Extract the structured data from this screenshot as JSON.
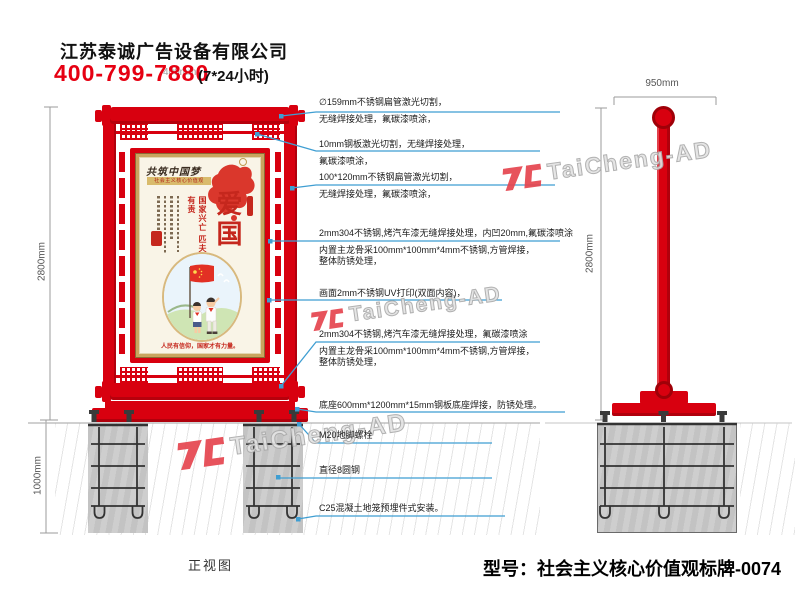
{
  "header": {
    "company": "江苏泰诚广告设备有限公司",
    "phone": "400-799-7880",
    "hours": "(7*24小时)",
    "overlay_dim": "400mm"
  },
  "watermark_text": "TaiCheng-AD",
  "front_view": {
    "label": "正视图",
    "dim_height": "2800mm",
    "dim_underground": "1000mm",
    "poster": {
      "calligraphy": "共筑中国梦",
      "band": "社会主义核心价值观",
      "headline": "爱国",
      "slogan_col1": "国家兴亡",
      "slogan_col2": "匹夫有责",
      "footer": "人民有信仰，国家才有力量。"
    }
  },
  "side_view": {
    "dim_width": "950mm",
    "dim_height": "2800mm"
  },
  "annotations": [
    {
      "lines": [
        "∅159mm不锈钢扁管激光切割，",
        "无缝焊接处理，氟碳漆喷涂，"
      ]
    },
    {
      "lines": [
        "10mm钢板激光切割，无缝焊接处理，",
        "氟碳漆喷涂，"
      ]
    },
    {
      "lines": [
        "100*120mm不锈钢扁管激光切割，",
        "无缝焊接处理，氟碳漆喷涂，"
      ]
    },
    {
      "lines": [
        "2mm304不锈钢,烤汽车漆无缝焊接处理，内凹20mm,氟碳漆喷涂",
        "内置主龙骨采100mm*100mm*4mm不锈钢,方管焊接，",
        "整体防锈处理，"
      ]
    },
    {
      "lines": [
        "画面2mm不锈钢UV打印(双面内容)，"
      ]
    },
    {
      "lines": [
        "2mm304不锈钢,烤汽车漆无缝焊接处理，氟碳漆喷涂",
        "内置主龙骨采100mm*100mm*4mm不锈钢,方管焊接，",
        "整体防锈处理，"
      ]
    },
    {
      "lines": [
        "底座600mm*1200mm*15mm钢板底座焊接，防锈处理。"
      ]
    },
    {
      "lines": [
        "M20地脚螺栓"
      ]
    },
    {
      "lines": [
        "直径8圆钢"
      ]
    },
    {
      "lines": [
        "C25混凝土地笼预埋件式安装。"
      ]
    }
  ],
  "model_label": "型号：社会主义核心价值观标牌-0074"
}
